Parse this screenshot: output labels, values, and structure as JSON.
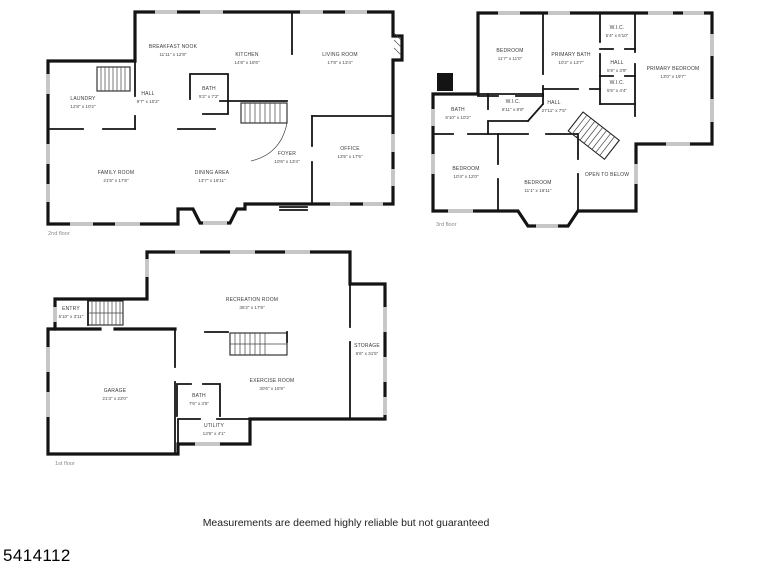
{
  "footer": {
    "disclaimer": "Measurements are deemed highly reliable but not guaranteed",
    "listing_id": "5414112"
  },
  "floors": {
    "second": {
      "label": "2nd floor",
      "rooms": [
        {
          "name": "BREAKFAST NOOK",
          "dims": "11'11\" x 12'8\""
        },
        {
          "name": "KITCHEN",
          "dims": "14'8\" x 18'6\""
        },
        {
          "name": "LIVING ROOM",
          "dims": "17'8\" x 13'4\""
        },
        {
          "name": "LAUNDRY",
          "dims": "12'8\" x 10'2\""
        },
        {
          "name": "HALL",
          "dims": "9'7\" x 10'2\""
        },
        {
          "name": "BATH",
          "dims": "5'2\" x 7'2\""
        },
        {
          "name": "FAMILY ROOM",
          "dims": "21'5\" x 17'8\""
        },
        {
          "name": "DINING AREA",
          "dims": "13'7\" x 16'11\""
        },
        {
          "name": "FOYER",
          "dims": "10'6\" x 13'4\""
        },
        {
          "name": "OFFICE",
          "dims": "13'5\" x 17'5\""
        }
      ]
    },
    "third": {
      "label": "3rd floor",
      "rooms": [
        {
          "name": "BEDROOM",
          "dims": "11'7\" x 11'0\""
        },
        {
          "name": "PRIMARY BATH",
          "dims": "10'2\" x 13'7\""
        },
        {
          "name": "W.I.C.",
          "dims": "5'4\" x 6'10\""
        },
        {
          "name": "HALL",
          "dims": "5'9\" x 3'9\""
        },
        {
          "name": "W.I.C.",
          "dims": "5'5\" x 4'4\""
        },
        {
          "name": "PRIMARY BEDROOM",
          "dims": "13'0\" x 19'7\""
        },
        {
          "name": "BATH",
          "dims": "6'10\" x 10'2\""
        },
        {
          "name": "W.I.C.",
          "dims": "6'11\" x 8'9\""
        },
        {
          "name": "HALL",
          "dims": "27'11\" x 7'5\""
        },
        {
          "name": "BEDROOM",
          "dims": "10'4\" x 12'0\""
        },
        {
          "name": "BEDROOM",
          "dims": "11'1\" x 16'11\""
        },
        {
          "name": "OPEN TO BELOW",
          "dims": ""
        }
      ]
    },
    "first": {
      "label": "1st floor",
      "rooms": [
        {
          "name": "ENTRY",
          "dims": "5'10\" x 3'11\""
        },
        {
          "name": "RECREATION ROOM",
          "dims": "35'2\" x 17'9\""
        },
        {
          "name": "STORAGE",
          "dims": "6'6\" x 31'5\""
        },
        {
          "name": "EXERCISE ROOM",
          "dims": "30'6\" x 15'9\""
        },
        {
          "name": "BATH",
          "dims": "7'6\" x 3'5\""
        },
        {
          "name": "UTILITY",
          "dims": "13'6\" x 4'1\""
        },
        {
          "name": "GARAGE",
          "dims": "21'3\" x 23'0\""
        }
      ]
    }
  }
}
